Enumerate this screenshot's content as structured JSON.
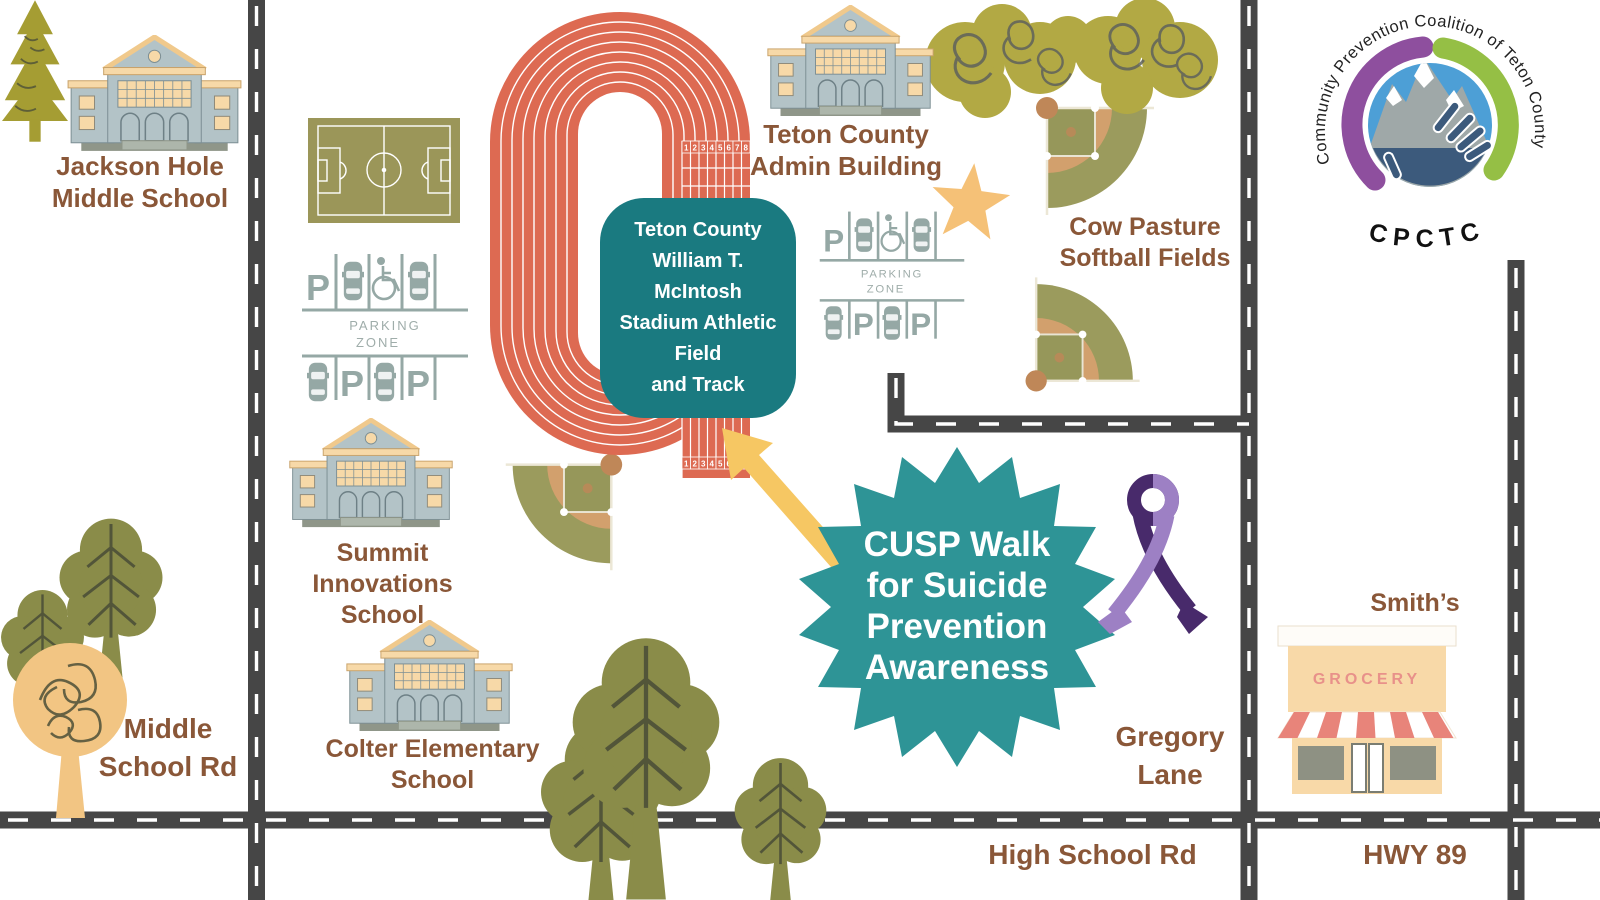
{
  "colors": {
    "track_red": "#dd6a52",
    "teal_box": "#1a7a80",
    "badge_teal": "#2e9496",
    "road_gray": "#464646",
    "label_brown": "#8a5738",
    "field_olive": "#9b9a58",
    "infield_tan": "#d2a06d",
    "parking_gray": "#95a8a5",
    "building_gray": "#b3c3c7",
    "building_tan": "#f7d9a8",
    "star_yellow": "#f5c177",
    "arrow_yellow": "#f6c763",
    "ribbon_light": "#9d80c4",
    "ribbon_dark": "#482a6b",
    "awning_salmon": "#e8847a",
    "grocery_pink": "#e8918a",
    "tree_olive": "#8a8c49",
    "scribble_olive": "#b2a944",
    "yellow_tree": "#f2c583",
    "logo_purple": "#8e4f9e",
    "logo_green": "#95bf45",
    "logo_blue": "#4d9fd6",
    "logo_navy": "#3c5a7c"
  },
  "places": {
    "jackson": {
      "line1": "Jackson Hole",
      "line2": "Middle School"
    },
    "admin": {
      "line1": "Teton County",
      "line2": "Admin Building"
    },
    "cow_pasture": {
      "line1": "Cow Pasture",
      "line2": "Softball Fields"
    },
    "summit": {
      "line1": "Summit Innovations",
      "line2": "School"
    },
    "colter": {
      "line1": "Colter Elementary",
      "line2": "School"
    },
    "smiths": {
      "name": "Smith’s",
      "sign": "GROCERY"
    }
  },
  "roads": {
    "middle_school_rd": {
      "line1": "Middle",
      "line2": "School Rd"
    },
    "gregory_lane": {
      "line1": "Gregory",
      "line2": "Lane"
    },
    "high_school_rd": "High School Rd",
    "hwy_89": "HWY 89"
  },
  "stadium_label": {
    "line1": "Teton County",
    "line2": "William T.",
    "line3": "McIntosh",
    "line4": "Stadium Athletic",
    "line5": "Field",
    "line6": "and Track"
  },
  "event_badge": {
    "line1": "CUSP Walk",
    "line2": "for Suicide",
    "line3": "Prevention",
    "line4": "Awareness"
  },
  "parking": {
    "zone_line1": "PARKING",
    "zone_line2": "ZONE",
    "p": "P"
  },
  "track": {
    "lanes_top": [
      "1",
      "2",
      "3",
      "4",
      "5",
      "6",
      "7",
      "8"
    ],
    "lanes_bottom": [
      "1",
      "2",
      "3",
      "4",
      "5",
      "6",
      "7",
      "8"
    ]
  },
  "logo": {
    "arc_text": "Community Prevention Coalition of Teton County",
    "acronym": "CPCTC"
  }
}
